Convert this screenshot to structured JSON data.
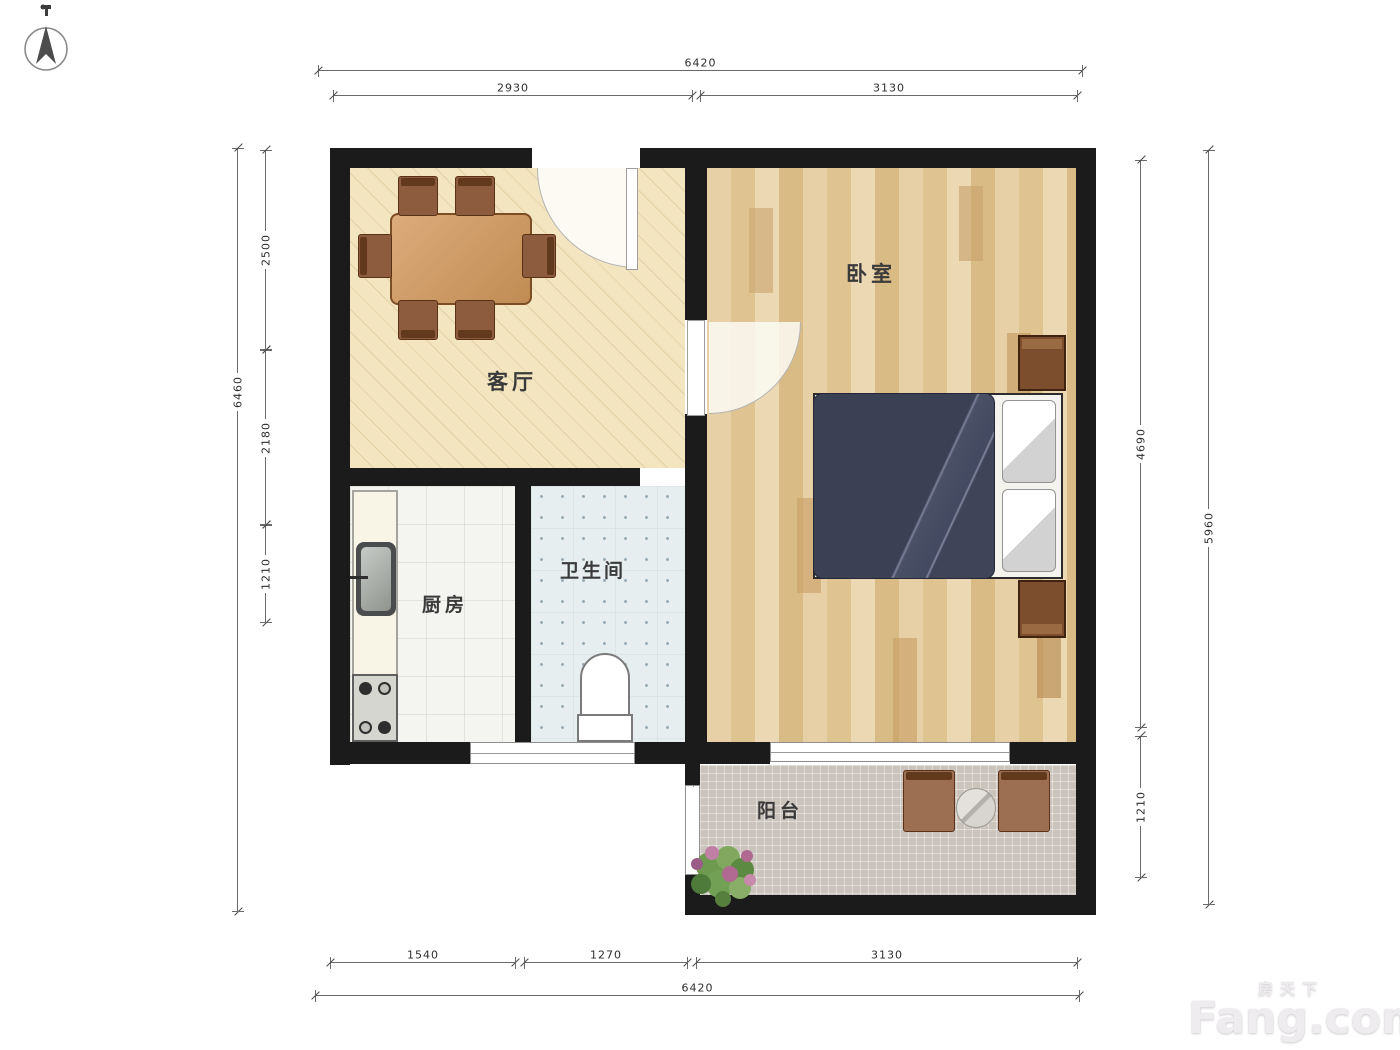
{
  "title": "apartment-floor-plan",
  "rooms": {
    "living_room": "客厅",
    "bedroom": "卧室",
    "kitchen": "厨房",
    "bathroom": "卫生间",
    "balcony": "阳台"
  },
  "dimensions": {
    "top": {
      "outer": "6420",
      "segments": [
        "2930",
        "3130"
      ]
    },
    "bottom": {
      "outer": "6420",
      "segments": [
        "1540",
        "1270",
        "3130"
      ]
    },
    "left": {
      "outer": "6460",
      "segments": [
        "2500",
        "2180",
        "1210"
      ]
    },
    "right": {
      "outer": "5960",
      "segments": [
        "4690",
        "1210"
      ]
    }
  },
  "watermark": {
    "brand_cn": "房天下",
    "brand_en": "Fang.com"
  },
  "icons": {
    "compass": "north-compass"
  },
  "colors": {
    "wall": "#1b1b1b",
    "living_floor": "#f3e5c0",
    "bedroom_floor": "#ead5ae",
    "bathroom_floor": "#e7eef0",
    "balcony_floor": "#cac4bd",
    "bed_duvet": "#3b4055",
    "furniture_wood": "#8d5c3e"
  }
}
